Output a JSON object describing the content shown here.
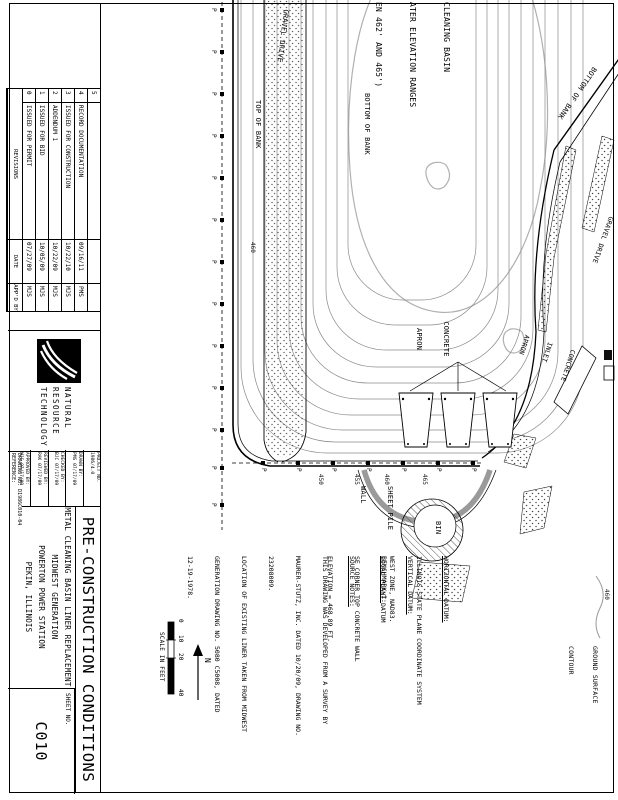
{
  "titleblock": {
    "main_title": "PRE-CONSTRUCTION CONDITIONS",
    "subtitles": [
      "METAL CLEANING BASIN LINER REPLACEMENT",
      "MIDWEST GENERATION",
      "POWERTON POWER STATION",
      "PEKIN, ILLINOIS"
    ],
    "sheet_no_label": "SHEET NO.",
    "sheet_no": "C010",
    "logo_lines": [
      "NATURAL",
      "RESOURCE",
      "TECHNOLOGY"
    ],
    "fields": [
      {
        "label": "PROJECT NO.",
        "value": "1986/4.0"
      },
      {
        "label": "DRAWN BY:",
        "value": "PMS 07/17/09"
      },
      {
        "label": "CHECKED BY:",
        "value": "BJC 07/17/09"
      },
      {
        "label": "REVIEWED BY:",
        "value": "RAK 07/17/09"
      },
      {
        "label": "APPROVED BY:",
        "value": "MJS 07/17/09"
      }
    ],
    "drawing_no": "DRAWING NO: D1986C010-04",
    "reference": "REFERENCE:",
    "revisions": {
      "rows": [
        {
          "no": "5",
          "desc": "",
          "date": "",
          "by": ""
        },
        {
          "no": "4",
          "desc": "RECORD DOCUMENTATION",
          "date": "09/16/11",
          "by": "PMS"
        },
        {
          "no": "3",
          "desc": "ISSUED FOR CONSTRUCTION",
          "date": "10/22/10",
          "by": "MJS"
        },
        {
          "no": "2",
          "desc": "ADDENDUM 1",
          "date": "10/22/09",
          "by": "MJS"
        },
        {
          "no": "1",
          "desc": "ISSUED FOR BID",
          "date": "10/05/09",
          "by": "MJS"
        },
        {
          "no": "0",
          "desc": "ISSUED FOR PERMIT",
          "date": "07/27/09",
          "by": "MJS"
        }
      ],
      "footer_label": "REVISIONS",
      "date_header": "DATE",
      "appd_header": "APP'D BY"
    }
  },
  "plan": {
    "labels": {
      "cleaning_basin_lines": [
        "CLEANING BASIN",
        "ATER ELEVATION RANGES",
        "EN 462' AND 465')"
      ],
      "gravel_drive": "GRAVEL DRIVE",
      "top_of_bank": "TOP OF BANK",
      "bottom_of_bank": "BOTTOM OF BANK",
      "concrete_apron_lines": [
        "CONCRETE",
        "APRON"
      ],
      "inlet_apron_lines": [
        "CONCRETE",
        "INLET",
        "APRON"
      ],
      "sheet_pile_wall_lines": [
        "SHEET PILE",
        "WALL"
      ],
      "bin": "BIN",
      "marker": "P"
    },
    "contour_labels": [
      "460",
      "465",
      "460",
      "455",
      "450"
    ],
    "legend": {
      "value": "460",
      "lines": [
        "GROUND SURFACE",
        "CONTOUR"
      ]
    },
    "north": "N",
    "scale": {
      "ticks": [
        "0",
        "10",
        "20",
        "40"
      ],
      "caption": "SCALE IN FEET"
    },
    "notes": {
      "horizontal_datum": {
        "title": "HORIZONTAL DATUM:",
        "lines": [
          "ILLINOIS STATE PLANE COORDINATE SYSTEM",
          "WEST ZONE, NAD83."
        ]
      },
      "vertical_datum": {
        "title": "VERTICAL DATUM:",
        "lines": [
          "LOCAL PLANT DATUM"
        ]
      },
      "benchmark": {
        "title": "BENCHMARK-1:",
        "lines": [
          "SE CORNER TOP CONCRETE WALL",
          "ELEVATION = 468.89 FT."
        ]
      },
      "source_notes": {
        "title": "SOURCE NOTES:",
        "lines": [
          "THIS DRAWING WAS DEVELOPED FROM A SURVEY BY",
          "MAURER-STUTZ, INC. DATED 10/20/09, DRAWING NO.",
          "23208009.",
          "LOCATION OF EXISTING LINER TAKEN FROM MIDWEST",
          "GENERATION DRAWING NO. 5080 C5008, DATED",
          "12-19-1978."
        ]
      }
    }
  },
  "colors": {
    "line": "#000000",
    "contour": "#8a8a8a",
    "water": "#b0b0b0",
    "wall_gray": "#9a9a9a"
  }
}
